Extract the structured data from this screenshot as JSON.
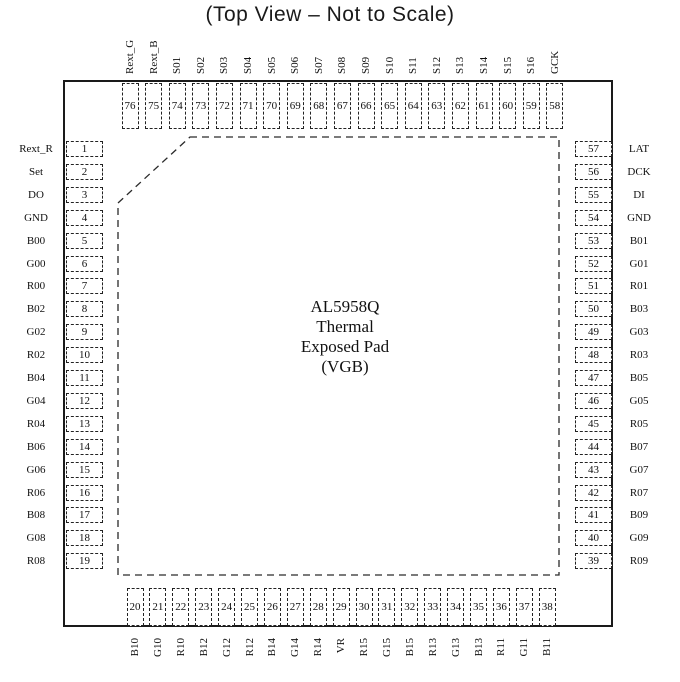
{
  "title": "(Top View – Not to Scale)",
  "chip": {
    "center_label_lines": [
      "AL5958Q",
      "Thermal",
      "Exposed Pad",
      "(VGB)"
    ]
  },
  "colors": {
    "ink": "#1a1a1a",
    "background": "#ffffff"
  },
  "pins": {
    "top": [
      {
        "num": "76",
        "label": "Rext_G"
      },
      {
        "num": "75",
        "label": "Rext_B"
      },
      {
        "num": "74",
        "label": "S01"
      },
      {
        "num": "73",
        "label": "S02"
      },
      {
        "num": "72",
        "label": "S03"
      },
      {
        "num": "71",
        "label": "S04"
      },
      {
        "num": "70",
        "label": "S05"
      },
      {
        "num": "69",
        "label": "S06"
      },
      {
        "num": "68",
        "label": "S07"
      },
      {
        "num": "67",
        "label": "S08"
      },
      {
        "num": "66",
        "label": "S09"
      },
      {
        "num": "65",
        "label": "S10"
      },
      {
        "num": "64",
        "label": "S11"
      },
      {
        "num": "63",
        "label": "S12"
      },
      {
        "num": "62",
        "label": "S13"
      },
      {
        "num": "61",
        "label": "S14"
      },
      {
        "num": "60",
        "label": "S15"
      },
      {
        "num": "59",
        "label": "S16"
      },
      {
        "num": "58",
        "label": "GCK"
      }
    ],
    "left": [
      {
        "num": "1",
        "label": "Rext_R"
      },
      {
        "num": "2",
        "label": "Set"
      },
      {
        "num": "3",
        "label": "DO"
      },
      {
        "num": "4",
        "label": "GND"
      },
      {
        "num": "5",
        "label": "B00"
      },
      {
        "num": "6",
        "label": "G00"
      },
      {
        "num": "7",
        "label": "R00"
      },
      {
        "num": "8",
        "label": "B02"
      },
      {
        "num": "9",
        "label": "G02"
      },
      {
        "num": "10",
        "label": "R02"
      },
      {
        "num": "11",
        "label": "B04"
      },
      {
        "num": "12",
        "label": "G04"
      },
      {
        "num": "13",
        "label": "R04"
      },
      {
        "num": "14",
        "label": "B06"
      },
      {
        "num": "15",
        "label": "G06"
      },
      {
        "num": "16",
        "label": "R06"
      },
      {
        "num": "17",
        "label": "B08"
      },
      {
        "num": "18",
        "label": "G08"
      },
      {
        "num": "19",
        "label": "R08"
      }
    ],
    "right": [
      {
        "num": "57",
        "label": "LAT"
      },
      {
        "num": "56",
        "label": "DCK"
      },
      {
        "num": "55",
        "label": "DI"
      },
      {
        "num": "54",
        "label": "GND"
      },
      {
        "num": "53",
        "label": "B01"
      },
      {
        "num": "52",
        "label": "G01"
      },
      {
        "num": "51",
        "label": "R01"
      },
      {
        "num": "50",
        "label": "B03"
      },
      {
        "num": "49",
        "label": "G03"
      },
      {
        "num": "48",
        "label": "R03"
      },
      {
        "num": "47",
        "label": "B05"
      },
      {
        "num": "46",
        "label": "G05"
      },
      {
        "num": "45",
        "label": "R05"
      },
      {
        "num": "44",
        "label": "B07"
      },
      {
        "num": "43",
        "label": "G07"
      },
      {
        "num": "42",
        "label": "R07"
      },
      {
        "num": "41",
        "label": "B09"
      },
      {
        "num": "40",
        "label": "G09"
      },
      {
        "num": "39",
        "label": "R09"
      }
    ],
    "bottom": [
      {
        "num": "20",
        "label": "B10"
      },
      {
        "num": "21",
        "label": "G10"
      },
      {
        "num": "22",
        "label": "R10"
      },
      {
        "num": "23",
        "label": "B12"
      },
      {
        "num": "24",
        "label": "G12"
      },
      {
        "num": "25",
        "label": "R12"
      },
      {
        "num": "26",
        "label": "B14"
      },
      {
        "num": "27",
        "label": "G14"
      },
      {
        "num": "28",
        "label": "R14"
      },
      {
        "num": "29",
        "label": "VR"
      },
      {
        "num": "30",
        "label": "R15"
      },
      {
        "num": "31",
        "label": "G15"
      },
      {
        "num": "32",
        "label": "B15"
      },
      {
        "num": "33",
        "label": "R13"
      },
      {
        "num": "34",
        "label": "G13"
      },
      {
        "num": "35",
        "label": "B13"
      },
      {
        "num": "36",
        "label": "R11"
      },
      {
        "num": "37",
        "label": "G11"
      },
      {
        "num": "38",
        "label": "B11"
      }
    ]
  }
}
